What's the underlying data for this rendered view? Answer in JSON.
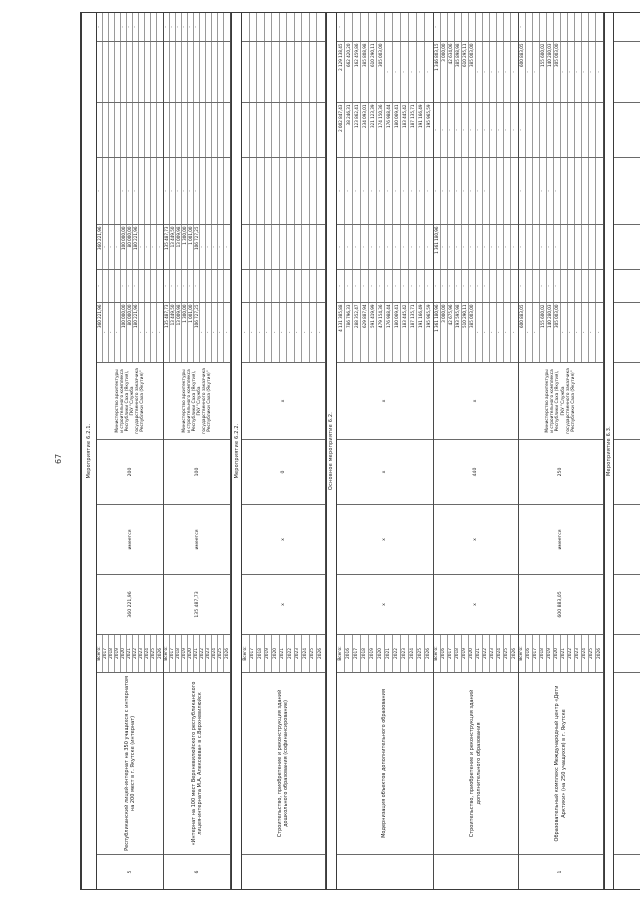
{
  "page_number": "67",
  "ministry_executor": {
    "lines": [
      "Министерство архитектуры",
      "и строительного комплекса",
      "Республики Саха (Якутия),",
      "ГКУ \"Служба",
      "государственного заказчика",
      "Республики Саха (Якутия)\""
    ]
  },
  "table": {
    "blocks": [
      {
        "type": "section",
        "label": "Мероприятие 6.2.1."
      },
      {
        "type": "object",
        "number": "5",
        "name": "Республиканский лицей-интернат на 350 учащихся с интернатом на 200 мест в г. Якутске (интернат)",
        "years": [
          "Всего:",
          "2017",
          "2018",
          "2019",
          "2020",
          "2021",
          "2022",
          "2023",
          "2024",
          "2025",
          "2026"
        ],
        "cost": "360 221,96",
        "psd": "имеется",
        "capacity": "200",
        "executor": "ministry",
        "f1": [
          "360 221,96",
          "-",
          "-",
          "-",
          "100 000,00",
          "80 000,00",
          "180 221,96",
          "-",
          "-",
          "-",
          "-"
        ],
        "f2": [
          "-",
          "",
          "",
          "",
          "-",
          "-",
          "-",
          "",
          "",
          "",
          ""
        ],
        "f3": [
          "360 221,96",
          "-",
          "-",
          "-",
          "100 000,00",
          "80 000,00",
          "180 221,96",
          "-",
          "-",
          "-",
          "-"
        ],
        "f4": [
          "-",
          "",
          "",
          "",
          "-",
          "-",
          "-",
          "",
          "",
          "",
          ""
        ],
        "f5": [
          "",
          "",
          "",
          "",
          "",
          "",
          "",
          "",
          "",
          "",
          ""
        ],
        "f6": [
          "",
          "",
          "",
          "",
          "",
          "",
          "",
          "",
          "",
          "",
          ""
        ],
        "f7": [
          "-",
          "",
          "",
          "",
          "-",
          "-",
          "-",
          "",
          "",
          "",
          ""
        ]
      },
      {
        "type": "object",
        "number": "6",
        "name": "«Интернат на 100 мест Верхневилюйского республиканского лицея-интерната М.А. Алексеева» в с.Верхневилюйск",
        "years": [
          "Всего:",
          "2017",
          "2018",
          "2019",
          "2020",
          "2021",
          "2022",
          "2023",
          "2024",
          "2025",
          "2026"
        ],
        "cost": "135 487,73",
        "psd": "имеется",
        "capacity": "100",
        "executor": "ministry",
        "f1": [
          "135 487,73",
          "13 449,50",
          "13 009,98",
          "1 300,00",
          "1 001,00",
          "106 727,25",
          "-",
          "-",
          "-",
          "-",
          "-"
        ],
        "f2": [
          "-",
          "-",
          "-",
          "-",
          "-",
          "-",
          "",
          "",
          "",
          "",
          ""
        ],
        "f3": [
          "135 487,73",
          "13 449,50",
          "13 009,98",
          "1 300,00",
          "1 001,00",
          "106 727,25",
          "-",
          "-",
          "-",
          "-",
          "-"
        ],
        "f4": [
          "-",
          "-",
          "-",
          "-",
          "-",
          "-",
          "",
          "",
          "",
          "",
          ""
        ],
        "f5": [
          "",
          "",
          "",
          "",
          "",
          "",
          "",
          "",
          "",
          "",
          ""
        ],
        "f6": [
          "",
          "",
          "",
          "",
          "",
          "",
          "",
          "",
          "",
          "",
          ""
        ],
        "f7": [
          "-",
          "-",
          "-",
          "-",
          "-",
          "-",
          "",
          "",
          "",
          "",
          ""
        ]
      },
      {
        "type": "section",
        "label": "Мероприятие 6.2.2."
      },
      {
        "type": "object",
        "number": "",
        "name": "Строительство, приобретение и реконструкция зданий дошкольного образования (софинансирование)",
        "years": [
          "Всего:",
          "2017",
          "2018",
          "2019",
          "2020",
          "2021",
          "2022",
          "2023",
          "2024",
          "2025",
          "2026"
        ],
        "cost": "х",
        "psd": "х",
        "capacity": "0",
        "executor": "х",
        "f1": [
          "-",
          "-",
          "-",
          "-",
          "-",
          "-",
          "-",
          "-",
          "-",
          "-",
          "-"
        ],
        "f2": [
          "",
          "",
          "",
          "",
          "",
          "",
          "",
          "",
          "",
          "",
          ""
        ],
        "f3": [
          "",
          "",
          "",
          "",
          "",
          "",
          "",
          "",
          "",
          "",
          ""
        ],
        "f4": [
          "",
          "",
          "",
          "",
          "",
          "",
          "",
          "",
          "",
          "",
          ""
        ],
        "f5": [
          "",
          "",
          "",
          "",
          "",
          "",
          "",
          "",
          "",
          "",
          ""
        ],
        "f6": [
          "",
          "",
          "",
          "",
          "",
          "",
          "",
          "",
          "",
          "",
          ""
        ],
        "f7": [
          "",
          "",
          "",
          "",
          "",
          "",
          "",
          "",
          "",
          "",
          ""
        ]
      },
      {
        "type": "section",
        "label": "Основное мероприятие 6.2."
      },
      {
        "type": "object",
        "number": "",
        "name": "Модернизация объектов дополнительного образования",
        "years": [
          "Всего:",
          "2016",
          "2017",
          "2018",
          "2019",
          "2020",
          "2021",
          "2022",
          "2023",
          "2024",
          "2025",
          "2026"
        ],
        "cost": "х",
        "psd": "х",
        "capacity": "х",
        "executor": "х",
        "f1": [
          "4 131 385,88",
          "786 796,33",
          "288 352,47",
          "629 887,94",
          "591 419,99",
          "479 154,36",
          "176 988,44",
          "180 069,41",
          "183 445,42",
          "187 135,71",
          "191 166,49",
          "195 965,59"
        ],
        "f2": [
          "-",
          "-",
          "-",
          "-",
          "-",
          "-",
          "-",
          "-",
          "-",
          "-",
          "-",
          "-"
        ],
        "f3": [
          "-",
          "-",
          "-",
          "-",
          "-",
          "-",
          "-",
          "-",
          "-",
          "-",
          "-",
          "-"
        ],
        "f4": [
          "-",
          "-",
          "-",
          "-",
          "-",
          "-",
          "-",
          "-",
          "-",
          "-",
          "-",
          "-"
        ],
        "f5": [
          "2 002 847,43",
          "38 246,31",
          "123 862,41",
          "234 093,01",
          "321 123,39",
          "174 150,36",
          "176 988,44",
          "180 069,41",
          "183 445,42",
          "187 135,71",
          "191 166,49",
          "195 965,59"
        ],
        "f6": [
          "2 129 138,45",
          "662 420,20",
          "162 459,86",
          "385 808,98",
          "610 290,11",
          "305 003,00",
          "-",
          "-",
          "-",
          "-",
          "-",
          "-"
        ],
        "f7": [
          "-",
          "",
          "",
          "",
          "",
          "",
          "",
          "",
          "",
          "",
          "",
          ""
        ]
      },
      {
        "type": "object",
        "number": "",
        "name": "Строительство, приобретение и реконструкция зданий дополнительного образования",
        "years": [
          "Всего:",
          "2016",
          "2017",
          "2018",
          "2019",
          "2020",
          "2021",
          "2022",
          "2023",
          "2024",
          "2025",
          "2026"
        ],
        "cost": "х",
        "psd": "х",
        "capacity": "440",
        "executor": "х",
        "f1": [
          "1 361 180,96",
          "3 000,00",
          "42 675,96",
          "193 595,98",
          "510 290,11",
          "385 003,00",
          "-",
          "-",
          "-",
          "-",
          "-",
          "-"
        ],
        "f2": [
          "-",
          "-",
          "-",
          "-",
          "-",
          "-",
          "-",
          "-",
          "",
          "",
          "",
          ""
        ],
        "f3": [
          "1 361 180,96",
          "-",
          "-",
          "-",
          "-",
          "-",
          "-",
          "-",
          "-",
          "-",
          "-",
          "-"
        ],
        "f4": [
          "-",
          "-",
          "-",
          "-",
          "-",
          "-",
          "-",
          "-",
          "",
          "",
          "",
          ""
        ],
        "f5": [
          "-",
          "-",
          "-",
          "-",
          "-",
          "-",
          "-",
          "-",
          "-",
          "-",
          "-",
          "-"
        ],
        "f6": [
          "1 346 803,15",
          "3 000,00",
          "42 634,06",
          "385 898,98",
          "610 295,11",
          "385 003,00",
          "-",
          "-",
          "-",
          "-",
          "-",
          "-"
        ],
        "f7": [
          "-",
          "",
          "",
          "",
          "",
          "",
          "",
          "",
          "",
          "",
          "",
          ""
        ]
      },
      {
        "type": "object",
        "number": "1",
        "name": "Образовательный комплекс Международный центр «Дети Арктики» (на 250 учащихся) в г. Якутске",
        "years": [
          "Всего:",
          "2016",
          "2017",
          "2018",
          "2019",
          "2020",
          "2021",
          "2022",
          "2023",
          "2024",
          "2025",
          "2026"
        ],
        "cost": "600 883,05",
        "psd": "имеется",
        "capacity": "250",
        "executor": "ministry",
        "f1": [
          "600 883,05",
          "-",
          "-",
          "155 600,02",
          "140 280,03",
          "305 003,00",
          "-",
          "-",
          "-",
          "-",
          "-",
          "-"
        ],
        "f2": [
          "-",
          "",
          "",
          "-",
          "-",
          "-",
          "",
          "",
          "",
          "",
          "",
          ""
        ],
        "f3": [
          "-",
          "",
          "",
          "-",
          "-",
          "-",
          "",
          "",
          "",
          "",
          "",
          ""
        ],
        "f4": [
          "-",
          "",
          "",
          "-",
          "-",
          "-",
          "",
          "",
          "",
          "",
          "",
          ""
        ],
        "f5": [
          "-",
          "",
          "",
          "",
          "",
          "",
          "",
          "",
          "",
          "",
          "",
          ""
        ],
        "f6": [
          "600 883,05",
          "-",
          "-",
          "155 600,02",
          "140 280,03",
          "305 003,00",
          "-",
          "-",
          "-",
          "-",
          "-",
          "-"
        ],
        "f7": [
          "-",
          "",
          "",
          "",
          "",
          "",
          "",
          "",
          "",
          "",
          "",
          ""
        ]
      },
      {
        "type": "section",
        "label": "Мероприятие 6.3."
      },
      {
        "type": "empty"
      }
    ]
  }
}
